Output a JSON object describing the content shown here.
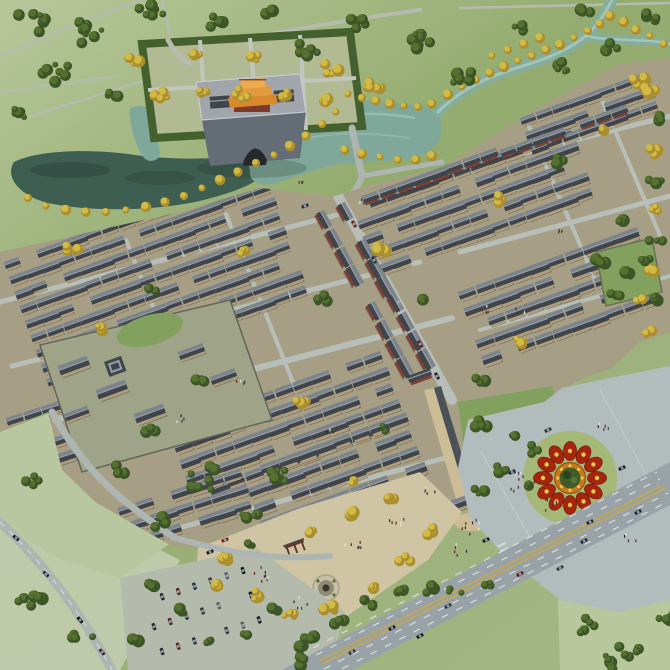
{
  "scene": {
    "kind": "aerial-architectural-rendering",
    "subject": "master plan of a traditional Chinese courtyard-house town",
    "features": [
      "city-gate-tower",
      "moat-lake",
      "winding-river",
      "courtyard-house-blocks",
      "main-street",
      "temple-compound",
      "memorial-archway-plaza",
      "flower-parterre",
      "pedestrian-plaza",
      "highway",
      "parking-lot",
      "farm-fields",
      "tree-clusters"
    ]
  },
  "palette": {
    "field-top": "#b8c79a",
    "field-mid": "#93ab6e",
    "field-low": "#a2b583",
    "field-pale": "#c6cfb3",
    "field-path": "#b5bcae",
    "lawn": "#b2ba94",
    "water-dark": "#3f5e52",
    "water-light": "#7fa89a",
    "water-river": "#84ad9e",
    "water-highlight": "#b0cec1",
    "road": "#aeb6b2",
    "street": "#b8bfb9",
    "town-ground": "#a79f85",
    "roof-dark": "#3f454b",
    "roof-light": "#7d848c",
    "roof-ridge": "#99a0a7",
    "wall-tan": "#b29e7d",
    "wall-red": "#7e4034",
    "gate-platform-top": "#a0a6ab",
    "gate-platform-front": "#646d75",
    "gate-roof-1": "#d8892e",
    "gate-roof-2": "#e29a3e",
    "gate-roof-3": "#eeab4e",
    "gate-wall-red": "#7c3a28",
    "tree-dark": "#3c5527",
    "tree-light": "#55702f",
    "tree-yellow": "#d2bb45",
    "tree-yellow-dark": "#ab8f2e",
    "plaza-grey": "#b3bcbd",
    "plaza-tan": "#cfc5a5",
    "park-green": "#82a05e",
    "lane-yellow": "#c9a843",
    "flower-red": "#a4260f",
    "flower-orange": "#c8791b",
    "flower-yellow": "#e8c94c",
    "flower-center": "#3f5c2a",
    "parterre-lawn": "#a6b878"
  },
  "render": {
    "house_blocks": [
      {
        "name": "northwest",
        "x": 4,
        "y": 262,
        "rot": -20,
        "cols": 16,
        "rows": 9,
        "colsp": 21,
        "rowsp": 19,
        "scale": 0.82
      },
      {
        "name": "north-center",
        "x": 352,
        "y": 206,
        "rot": -20,
        "cols": 13,
        "rows": 5,
        "colsp": 21,
        "rowsp": 19,
        "scale": 0.85
      },
      {
        "name": "riverside-shops",
        "x": 362,
        "y": 196,
        "rot": -20,
        "cols": 9,
        "rows": 1,
        "colsp": 21,
        "rowsp": 19,
        "scale": 0.85,
        "kind": "shop"
      },
      {
        "name": "northeast",
        "x": 458,
        "y": 292,
        "rot": -20,
        "cols": 10,
        "rows": 5,
        "colsp": 21,
        "rowsp": 19,
        "scale": 0.9
      },
      {
        "name": "northeast-corner",
        "x": 520,
        "y": 118,
        "rot": -20,
        "cols": 8,
        "rows": 3,
        "colsp": 21,
        "rowsp": 19,
        "scale": 0.8
      },
      {
        "name": "northeast-shops",
        "x": 500,
        "y": 150,
        "rot": -20,
        "cols": 8,
        "rows": 1,
        "colsp": 21,
        "rowsp": 19,
        "scale": 0.8,
        "kind": "shop"
      },
      {
        "name": "center",
        "x": 168,
        "y": 428,
        "rot": -20,
        "cols": 12,
        "rows": 5,
        "colsp": 21,
        "rowsp": 19,
        "scale": 0.9
      },
      {
        "name": "south-center",
        "x": 242,
        "y": 472,
        "rot": -20,
        "cols": 9,
        "rows": 4,
        "colsp": 21,
        "rowsp": 19,
        "scale": 0.92
      },
      {
        "name": "south-row",
        "x": 118,
        "y": 508,
        "rot": -18,
        "cols": 7,
        "rows": 3,
        "colsp": 21,
        "rowsp": 19,
        "scale": 0.88
      },
      {
        "name": "southwest-cluster",
        "x": 6,
        "y": 418,
        "rot": -18,
        "cols": 4,
        "rows": 4,
        "colsp": 21,
        "rowsp": 19,
        "scale": 0.88
      },
      {
        "name": "main-street-west",
        "x": 324,
        "y": 210,
        "rot": 61,
        "cols": 9,
        "rows": 1,
        "colsp": 22,
        "rowsp": 19,
        "scale": 0.95,
        "kind": "shop"
      },
      {
        "name": "main-street-east",
        "x": 345,
        "y": 202,
        "rot": 61,
        "cols": 9,
        "rows": 1,
        "colsp": 22,
        "rowsp": 19,
        "scale": 0.95,
        "kind": "shop"
      }
    ],
    "tree_clusters": [
      [
        30,
        22,
        16,
        7,
        "g"
      ],
      [
        85,
        30,
        18,
        8,
        "g"
      ],
      [
        150,
        14,
        13,
        6,
        "g"
      ],
      [
        55,
        72,
        15,
        7,
        "g"
      ],
      [
        15,
        112,
        12,
        5,
        "g"
      ],
      [
        110,
        96,
        10,
        4,
        "g"
      ],
      [
        215,
        22,
        11,
        5,
        "g"
      ],
      [
        265,
        12,
        9,
        4,
        "g"
      ],
      [
        305,
        52,
        14,
        6,
        "g"
      ],
      [
        355,
        24,
        11,
        5,
        "g"
      ],
      [
        415,
        42,
        15,
        7,
        "g"
      ],
      [
        465,
        80,
        13,
        6,
        "g"
      ],
      [
        520,
        30,
        11,
        5,
        "g"
      ],
      [
        560,
        70,
        11,
        5,
        "g"
      ],
      [
        610,
        48,
        10,
        4,
        "g"
      ],
      [
        648,
        20,
        9,
        4,
        "g"
      ],
      [
        372,
        88,
        10,
        5,
        "y"
      ],
      [
        330,
        70,
        9,
        4,
        "y"
      ],
      [
        255,
        60,
        8,
        4,
        "y"
      ],
      [
        195,
        55,
        8,
        4,
        "y"
      ],
      [
        135,
        60,
        8,
        4,
        "y"
      ],
      [
        585,
        12,
        8,
        4,
        "g"
      ],
      [
        640,
        80,
        8,
        4,
        "y"
      ],
      [
        30,
        598,
        15,
        6,
        "g"
      ],
      [
        82,
        636,
        12,
        5,
        "g"
      ],
      [
        30,
        480,
        9,
        4,
        "g"
      ],
      [
        205,
        480,
        19,
        8,
        "g"
      ],
      [
        252,
        514,
        13,
        6,
        "g"
      ],
      [
        160,
        522,
        9,
        4,
        "g"
      ],
      [
        120,
        470,
        8,
        4,
        "g"
      ],
      [
        278,
        470,
        9,
        4,
        "g"
      ],
      [
        585,
        625,
        11,
        5,
        "g"
      ],
      [
        628,
        648,
        12,
        5,
        "g"
      ],
      [
        665,
        615,
        9,
        4,
        "g"
      ],
      [
        608,
        662,
        10,
        4,
        "g"
      ],
      [
        308,
        636,
        7,
        4,
        "g"
      ],
      [
        338,
        620,
        7,
        4,
        "g"
      ],
      [
        368,
        604,
        7,
        4,
        "g"
      ],
      [
        398,
        590,
        7,
        4,
        "g"
      ],
      [
        428,
        588,
        7,
        3,
        "g"
      ],
      [
        455,
        592,
        7,
        3,
        "g"
      ],
      [
        485,
        585,
        6,
        3,
        "g"
      ],
      [
        300,
        660,
        8,
        4,
        "g"
      ],
      [
        652,
        90,
        7,
        3,
        "y"
      ],
      [
        655,
        120,
        7,
        3,
        "g"
      ],
      [
        652,
        150,
        7,
        3,
        "y"
      ],
      [
        656,
        180,
        7,
        3,
        "g"
      ],
      [
        652,
        210,
        7,
        3,
        "y"
      ],
      [
        656,
        240,
        7,
        3,
        "g"
      ],
      [
        652,
        270,
        7,
        3,
        "y"
      ],
      [
        655,
        300,
        7,
        3,
        "g"
      ],
      [
        650,
        330,
        7,
        3,
        "y"
      ],
      [
        70,
        250,
        8,
        4,
        "y"
      ],
      [
        150,
        290,
        8,
        4,
        "g"
      ],
      [
        240,
        250,
        7,
        3,
        "y"
      ],
      [
        320,
        300,
        8,
        4,
        "g"
      ],
      [
        380,
        250,
        6,
        3,
        "y"
      ],
      [
        420,
        300,
        6,
        3,
        "g"
      ],
      [
        500,
        200,
        7,
        3,
        "y"
      ],
      [
        560,
        160,
        6,
        3,
        "g"
      ],
      [
        600,
        130,
        6,
        3,
        "y"
      ],
      [
        480,
        380,
        7,
        3,
        "g"
      ],
      [
        520,
        340,
        6,
        3,
        "y"
      ],
      [
        380,
        430,
        6,
        3,
        "g"
      ],
      [
        300,
        400,
        7,
        3,
        "y"
      ],
      [
        200,
        380,
        6,
        3,
        "g"
      ],
      [
        100,
        330,
        6,
        3,
        "y"
      ],
      [
        620,
        220,
        6,
        3,
        "g"
      ],
      [
        640,
        300,
        5,
        3,
        "y"
      ],
      [
        280,
        480,
        6,
        3,
        "g"
      ],
      [
        350,
        480,
        5,
        3,
        "y"
      ],
      [
        150,
        430,
        6,
        3,
        "g"
      ],
      [
        480,
        425,
        7,
        4,
        "g"
      ],
      [
        510,
        435,
        7,
        4,
        "g"
      ],
      [
        535,
        450,
        7,
        4,
        "g"
      ],
      [
        500,
        470,
        7,
        4,
        "g"
      ],
      [
        525,
        485,
        6,
        3,
        "g"
      ],
      [
        480,
        490,
        6,
        3,
        "g"
      ],
      [
        600,
        262,
        6,
        3,
        "g"
      ],
      [
        625,
        275,
        6,
        3,
        "g"
      ],
      [
        645,
        258,
        5,
        3,
        "g"
      ],
      [
        615,
        295,
        5,
        3,
        "g"
      ],
      [
        225,
        560,
        6,
        4,
        "y"
      ],
      [
        255,
        596,
        6,
        4,
        "y"
      ],
      [
        290,
        616,
        6,
        4,
        "y"
      ],
      [
        330,
        610,
        6,
        3,
        "y"
      ],
      [
        370,
        585,
        6,
        3,
        "y"
      ],
      [
        405,
        560,
        6,
        3,
        "y"
      ],
      [
        432,
        532,
        6,
        3,
        "y"
      ],
      [
        215,
        585,
        5,
        3,
        "y"
      ],
      [
        250,
        545,
        5,
        3,
        "g"
      ],
      [
        310,
        530,
        5,
        3,
        "y"
      ],
      [
        350,
        515,
        5,
        3,
        "y"
      ],
      [
        390,
        498,
        5,
        3,
        "y"
      ],
      [
        150,
        585,
        5,
        3,
        "g"
      ],
      [
        180,
        612,
        5,
        3,
        "g"
      ],
      [
        210,
        640,
        5,
        3,
        "g"
      ],
      [
        245,
        635,
        5,
        3,
        "g"
      ],
      [
        275,
        610,
        5,
        3,
        "g"
      ],
      [
        300,
        645,
        5,
        3,
        "g"
      ],
      [
        135,
        640,
        5,
        3,
        "g"
      ],
      [
        160,
        95,
        9,
        5,
        "y"
      ],
      [
        200,
        90,
        8,
        4,
        "y"
      ],
      [
        240,
        95,
        8,
        4,
        "y"
      ],
      [
        285,
        95,
        8,
        4,
        "y"
      ],
      [
        322,
        100,
        8,
        4,
        "y"
      ]
    ],
    "river_trees": [
      [
        348,
        94
      ],
      [
        362,
        98
      ],
      [
        376,
        101
      ],
      [
        390,
        104
      ],
      [
        404,
        106
      ],
      [
        418,
        107
      ],
      [
        432,
        104
      ],
      [
        448,
        95
      ],
      [
        462,
        87
      ],
      [
        476,
        80
      ],
      [
        490,
        73
      ],
      [
        504,
        67
      ],
      [
        518,
        61
      ],
      [
        532,
        56
      ],
      [
        546,
        50
      ],
      [
        560,
        45
      ],
      [
        574,
        38
      ],
      [
        588,
        31
      ],
      [
        600,
        24
      ],
      [
        610,
        16
      ],
      [
        336,
        112
      ],
      [
        322,
        124
      ],
      [
        306,
        136
      ],
      [
        290,
        146
      ],
      [
        274,
        155
      ],
      [
        256,
        163
      ],
      [
        238,
        172
      ],
      [
        220,
        180
      ],
      [
        202,
        188
      ],
      [
        184,
        196
      ],
      [
        165,
        202
      ],
      [
        146,
        207
      ],
      [
        126,
        210
      ],
      [
        106,
        212
      ],
      [
        86,
        212
      ],
      [
        66,
        210
      ],
      [
        46,
        206
      ],
      [
        28,
        198
      ],
      [
        345,
        150
      ],
      [
        362,
        154
      ],
      [
        380,
        157
      ],
      [
        398,
        160
      ],
      [
        416,
        160
      ],
      [
        432,
        156
      ],
      [
        650,
        36
      ],
      [
        664,
        44
      ],
      [
        636,
        30
      ],
      [
        624,
        22
      ],
      [
        492,
        56
      ],
      [
        508,
        50
      ],
      [
        524,
        44
      ],
      [
        540,
        38
      ]
    ],
    "highway_cars": [
      [
        392,
        628,
        -27,
        "#141e26"
      ],
      [
        448,
        606,
        -27,
        "#2a3640"
      ],
      [
        520,
        574,
        -27,
        "#5c1d1a"
      ],
      [
        584,
        541,
        -27,
        "#20262b"
      ],
      [
        638,
        512,
        -27,
        "#1b2830"
      ],
      [
        352,
        652,
        -27,
        "#2e3640"
      ],
      [
        420,
        636,
        -27,
        "#101820"
      ],
      [
        560,
        568,
        -27,
        "#30383f"
      ]
    ],
    "road_cars": [
      [
        16,
        538,
        40,
        "#1a222a"
      ],
      [
        46,
        574,
        44,
        "#2c3038"
      ],
      [
        80,
        620,
        48,
        "#14100e"
      ],
      [
        102,
        652,
        50,
        "#3a2326"
      ]
    ],
    "street_cars": [
      [
        354,
        224,
        61,
        "#6b1f1f"
      ],
      [
        374,
        260,
        61,
        "#242e38"
      ],
      [
        398,
        302,
        61,
        "#8a8f94"
      ],
      [
        420,
        344,
        61,
        "#5a1d1d"
      ],
      [
        437,
        376,
        61,
        "#1d242b"
      ],
      [
        305,
        206,
        -20,
        "#23303a"
      ],
      [
        225,
        540,
        -20,
        "#7c1f16"
      ],
      [
        210,
        552,
        -20,
        "#16181c"
      ]
    ],
    "plaza_cars": [
      [
        512,
        472,
        -25,
        "#1c242c"
      ],
      [
        590,
        522,
        -25,
        "#222a30"
      ],
      [
        622,
        468,
        -25,
        "#161c22"
      ],
      [
        548,
        430,
        -25,
        "#2a3138"
      ],
      [
        486,
        540,
        -25,
        "#101418"
      ]
    ],
    "parking": {
      "x": 146,
      "y": 602,
      "rot": -18,
      "cols": 7,
      "rows": 3,
      "colsp": 17,
      "rowsp": 26,
      "colors": [
        "#20262c",
        "#50262a",
        "#1d3040",
        "#303436",
        "#5c5f63",
        "#13171c"
      ]
    },
    "people_clusters": [
      [
        520,
        482,
        10,
        15
      ],
      [
        548,
        505,
        7,
        10
      ],
      [
        602,
        428,
        5,
        8
      ],
      [
        628,
        540,
        4,
        8
      ],
      [
        472,
        528,
        8,
        12
      ],
      [
        460,
        550,
        5,
        8
      ],
      [
        262,
        576,
        8,
        12
      ],
      [
        352,
        546,
        6,
        10
      ],
      [
        300,
        602,
        5,
        9
      ],
      [
        398,
        522,
        6,
        9
      ],
      [
        430,
        490,
        5,
        8
      ],
      [
        240,
        380,
        4,
        6
      ],
      [
        180,
        420,
        4,
        6
      ],
      [
        330,
        430,
        4,
        6
      ],
      [
        520,
        310,
        4,
        6
      ],
      [
        560,
        230,
        3,
        5
      ],
      [
        300,
        180,
        3,
        5
      ],
      [
        360,
        200,
        3,
        6
      ],
      [
        486,
        310,
        4,
        6
      ]
    ],
    "people_colors": [
      "#2a2a2a",
      "#4a342c",
      "#32405c",
      "#6b2020",
      "#e8e4da"
    ],
    "flower": {
      "cx": 570,
      "cy": 478,
      "lawn_r": 47,
      "petal_r": 27,
      "petals": 12,
      "inner_r": 15.5,
      "center_r": 10.5
    }
  }
}
